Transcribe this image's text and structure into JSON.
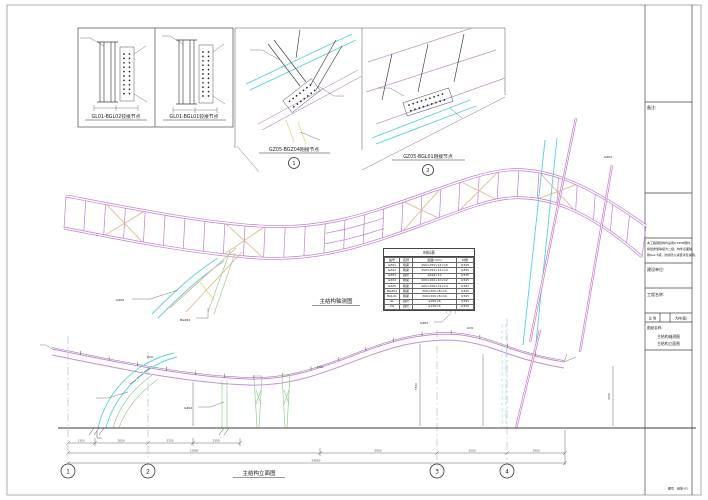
{
  "sheet": {
    "details": {
      "d1": "GL01-BGL02铰接节点",
      "d2": "GL01-BGL01铰接节点",
      "d3": "GZ05-BGZ04刚接节点",
      "d3_bubble": "1",
      "d4": "GZ05-BGL01刚接节点",
      "d4_bubble": "2"
    },
    "views": {
      "axon_title": "主结构轴测图",
      "elev_title": "主结构立面图"
    },
    "callouts": [
      "GZ05",
      "BGZ04",
      "GZ03",
      "GZ04",
      "GZ02"
    ],
    "material_table": {
      "title": "材料表",
      "headers": [
        "编号",
        "名称",
        "截面(mm)",
        "材质"
      ],
      "rows": [
        [
          "GZ01",
          "箱梁",
          "450×250×14×16",
          "Q345"
        ],
        [
          "GZ02",
          "箱梁",
          "450×250×12×14",
          "Q345"
        ],
        [
          "GZ03",
          "圆管",
          "φ299×10",
          "Q345"
        ],
        [
          "GZ04",
          "箱梁",
          "400×200×10×12",
          "Q345"
        ],
        [
          "GZ05",
          "箱梁",
          "400×200×12×14",
          "Q345"
        ],
        [
          "BGZ04",
          "箱梁",
          "300×200×8×10",
          "Q345"
        ],
        [
          "BGL01",
          "箱梁",
          "300×200×8×10",
          "Q345"
        ],
        [
          "GL",
          "圆管",
          "φ180×8",
          "Q345"
        ],
        [
          "XG",
          "圆管",
          "φ140×6",
          "Q345"
        ]
      ]
    },
    "grid_bubbles": [
      "1",
      "2",
      "3",
      "4"
    ],
    "dims": {
      "row1": [
        "1350",
        "2650",
        "2250",
        "2350"
      ],
      "row2": [
        "12600",
        "5850",
        "3500",
        "2900"
      ],
      "row3": [
        "24850"
      ],
      "heights": [
        "5560",
        "3260"
      ],
      "segs": [
        "2000",
        "2000",
        "2000"
      ]
    },
    "title_block": {
      "remark_label": "备注:",
      "notes": [
        "本工程钢结构均采用Q345B钢材，",
        "焊缝质量等级为二级；构件表面除",
        "锈Sa2.5级，防腐防火涂装详见说明。"
      ],
      "owner_label": "建设单位:",
      "project_label": "工程名称:",
      "scale_label": "比 例",
      "detail_label": "大样(图)",
      "sheet_name_label": "图纸名称:",
      "sheet_names": [
        "主结构轴测图",
        "主结构立面图"
      ],
      "sheet_no_label": "图号:",
      "sheet_no": "结施-05"
    }
  }
}
